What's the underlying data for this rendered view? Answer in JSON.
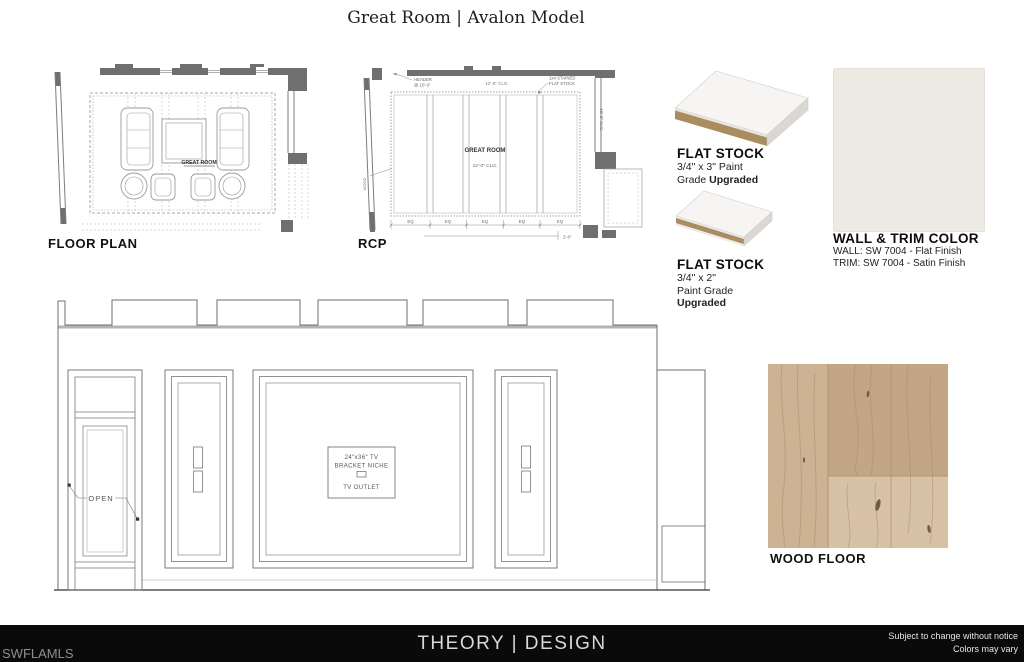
{
  "page": {
    "title": "Great Room | Avalon Model"
  },
  "drawings": {
    "floor_plan": {
      "label": "FLOOR PLAN",
      "room_label": "GREAT ROOM"
    },
    "rcp": {
      "label": "RCP",
      "room_label": "GREAT ROOM",
      "clg_center": "12'-0\" CLG.",
      "clg_top": "12'-0\" CLG.",
      "clg_right": "10'-0\" CLG.",
      "header_note_line1": "HEADER",
      "header_note_line2": "@ 10'-0\"",
      "stock_note_line1": "1x4 STAINED",
      "stock_note_line2": "FLAT STOCK",
      "left_note": "WOOD",
      "dim_eq": "EQ",
      "dim_right": "2'-0\""
    },
    "elevation": {
      "open_label": "OPEN",
      "niche_line1": "24\"x36\" TV",
      "niche_line2": "BRACKET NICHE",
      "outlet_label": "TV OUTLET"
    }
  },
  "samples": {
    "flat_stock_1": {
      "title": "FLAT STOCK",
      "spec_line1": "3/4\" x 3\" Paint",
      "spec_line2": "Grade ",
      "spec_bold": "Upgraded"
    },
    "flat_stock_2": {
      "title": "FLAT STOCK",
      "spec_line1": "3/4\" x 2\"",
      "spec_line2": "Paint Grade",
      "spec_bold": "Upgraded"
    },
    "wall_trim": {
      "title": "WALL & TRIM COLOR",
      "wall_line": "WALL: SW 7004 - Flat Finish",
      "trim_line": "TRIM: SW 7004 - Satin Finish",
      "swatch_color": "#edeae4"
    },
    "wood_floor": {
      "title": "WOOD FLOOR"
    }
  },
  "footer": {
    "watermark": "SWFLAMLS",
    "brand": "THEORY | DESIGN",
    "disclaimer_line1": "Subject to change without notice",
    "disclaimer_line2": "Colors may vary"
  },
  "colors": {
    "footer_bg": "#0a0a0a",
    "swatch": "#edeae4",
    "mdf_core": "#a98c60",
    "board_top": "#f6f5f3",
    "board_end": "#dbd8d4",
    "wood_light": "#cdb294",
    "wood_mid": "#c3a685",
    "wood_lower": "#d7c2a6"
  }
}
